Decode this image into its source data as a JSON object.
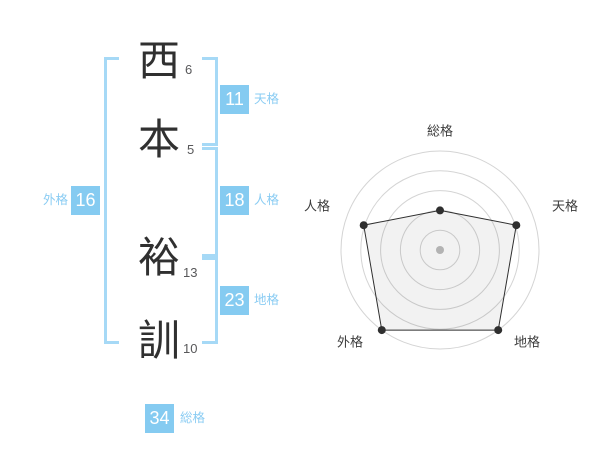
{
  "name_analysis": {
    "characters": [
      {
        "char": "西",
        "strokes": "6"
      },
      {
        "char": "本",
        "strokes": "5"
      },
      {
        "char": "裕",
        "strokes": "13"
      },
      {
        "char": "訓",
        "strokes": "10"
      }
    ],
    "results": {
      "tenkaku": {
        "label": "天格",
        "value": "11"
      },
      "jinkaku": {
        "label": "人格",
        "value": "18"
      },
      "chikaku": {
        "label": "地格",
        "value": "23"
      },
      "gaikaku": {
        "label": "外格",
        "value": "16"
      },
      "soukaku": {
        "label": "総格",
        "value": "34"
      }
    }
  },
  "colors": {
    "score_box_bg": "#85cbf1",
    "score_box_text": "#ffffff",
    "bracket_blue": "#a6d9f6",
    "label_blue": "#8accf3",
    "kanji_dark": "#303030",
    "stroke_num_gray": "#58585a"
  },
  "chart_data": {
    "type": "radar",
    "title": "",
    "categories": [
      "総格",
      "天格",
      "地格",
      "外格",
      "人格"
    ],
    "values": [
      34,
      11,
      23,
      16,
      18
    ],
    "radius_ratios": [
      0.4,
      0.81,
      1.0,
      1.0,
      0.81
    ],
    "rings": 5,
    "grid_shape": "circle",
    "axis_start": "top",
    "direction": "clockwise",
    "ring_color": "#d4d4d4",
    "series_color": "#2f2f2f",
    "fill_color": "rgba(0,0,0,0.05)",
    "marker_color": "#2f2f2f",
    "center_dot_color": "#bdbdbd",
    "label_color": "#3c3c3c",
    "legend": "none"
  }
}
